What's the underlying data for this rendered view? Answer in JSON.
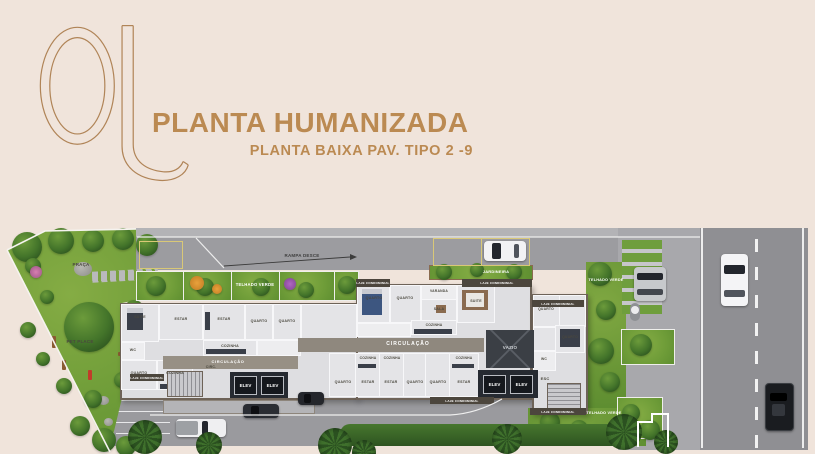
{
  "header": {
    "title": "PLANTA HUMANIZADA",
    "subtitle": "PLANTA BAIXA PAV. TIPO 2 -9"
  },
  "colors": {
    "accent": "#BB8A52",
    "background": "#F0E4DB",
    "lawn": "#74A03A",
    "road": "#8F8F93",
    "sidewalk": "#A8A8AC",
    "floor": "#E4E4E7",
    "corridor": "#8F887E",
    "dark_core": "#22262C",
    "strip": "#4C463D",
    "stall_yellow": "#D9C877"
  },
  "plan": {
    "areas": {
      "praca": "PRAÇA",
      "pet_place": "PET PLACE",
      "rampa_desce": "RAMPA DESCE",
      "telhado_verde": "TELHADO VERDE",
      "jardineira": "JARDINEIRA",
      "laje_condominial": "LAJE CONDOMINIAL",
      "circulacao": "CIRCULAÇÃO",
      "vazio": "VAZIO",
      "elev": "ELEV",
      "esc": "ESC",
      "circ": "CIRC."
    },
    "rooms": [
      "SUITE",
      "WC",
      "ESTAR",
      "QUARTO",
      "COZINHA",
      "ESTAR",
      "QUARTO",
      "QUARTO",
      "COZINHA",
      "QUARTO",
      "QUARTO",
      "VARANDA",
      "SALA",
      "COZINHA",
      "SUITE",
      "QUARTO",
      "QUARTO",
      "WC",
      "COZINHA",
      "COZINHA",
      "COZINHA",
      "QUARTO",
      "ESTAR",
      "ESTAR",
      "QUARTO",
      "QUARTO",
      "ESTAR"
    ]
  }
}
